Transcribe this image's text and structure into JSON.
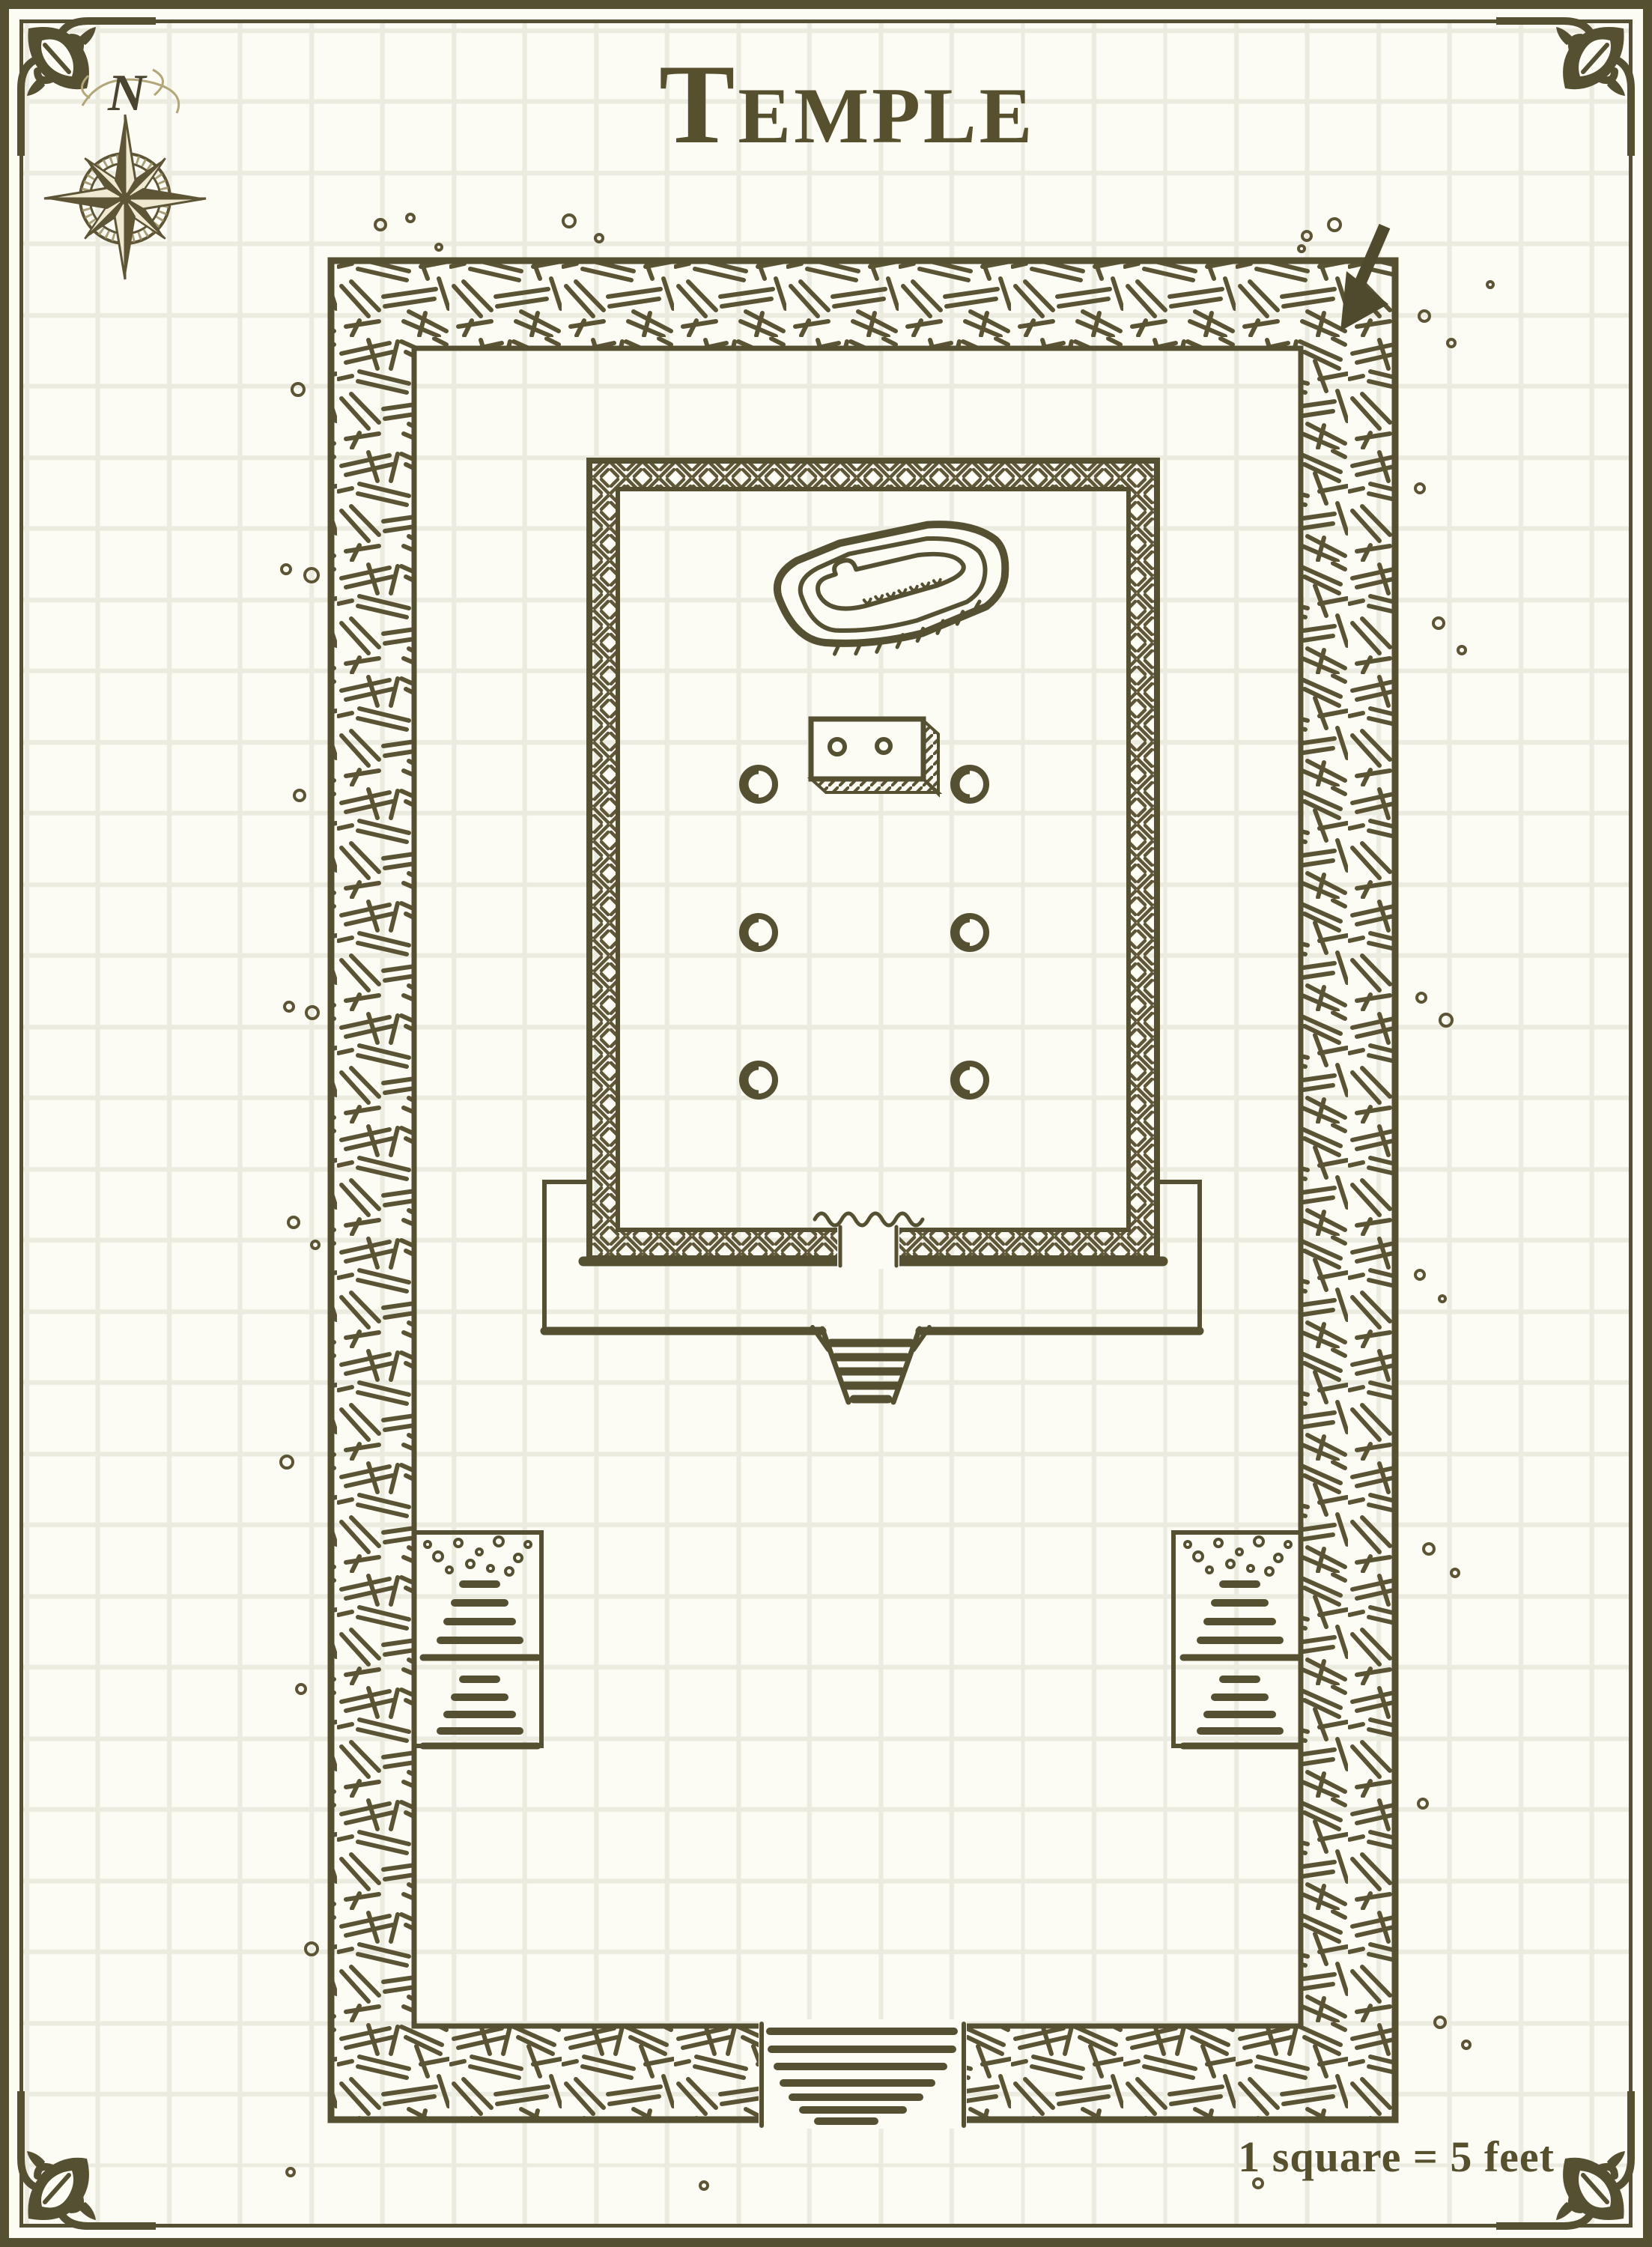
{
  "title": {
    "text": "Temple"
  },
  "compass": {
    "north_label": "N"
  },
  "scale": {
    "text": "1 square = 5 feet"
  },
  "map": {
    "name": "Temple",
    "grid": {
      "square_feet": 5,
      "legend": "1 square = 5 feet"
    },
    "features": [
      "outer-wall",
      "inner-sanctum-wall",
      "sarcophagus",
      "altar-with-candles",
      "six-pillars",
      "dais-with-steps",
      "left-staircase",
      "right-staircase",
      "entrance-steps",
      "compass-rose",
      "corner-arrow-marker",
      "scattered-rubble"
    ],
    "colors": {
      "ink": "#565033",
      "paper": "#fcfbf4",
      "grid_line": "#ecebe0",
      "compass_accent": "#9a8f63"
    }
  }
}
